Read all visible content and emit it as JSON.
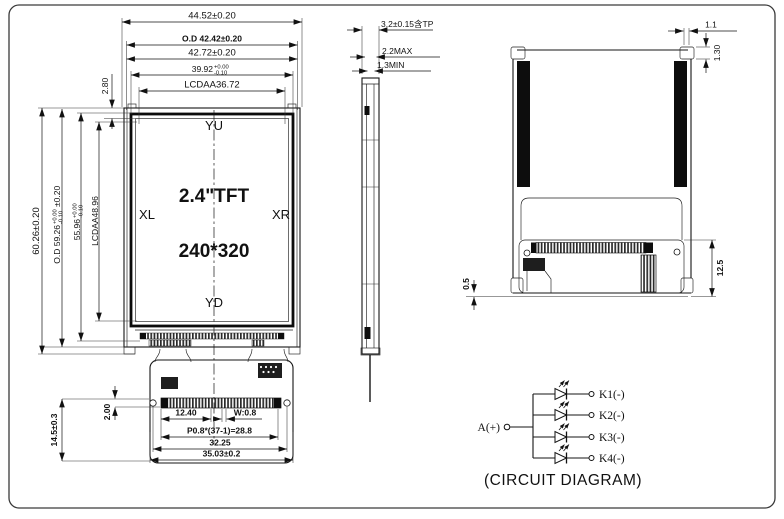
{
  "front": {
    "dims_top": {
      "total_width": "44.52±0.20",
      "od_width": "O.D 42.42±0.20",
      "frame_width": "42.72±0.20",
      "glass_width": "39.92",
      "glass_width_tol_up": "+0.00",
      "glass_width_tol_dn": "-0.10",
      "aa_width": "LCDAA36.72",
      "top_margin": "2.80"
    },
    "dims_left": {
      "total_height": "60.26±0.20",
      "od_height": "O.D 59.26",
      "od_height_tol_up": "+0.00",
      "od_height_tol_dn": "-0.10",
      "od_height_suffix": "±0.20",
      "pol_height": "55.96",
      "pol_height_tol_up": "+0.00",
      "pol_height_tol_dn": "-0.10",
      "aa_height": "LCDAA48.96"
    },
    "screen": {
      "marker_top": "YU",
      "marker_left": "XL",
      "marker_right": "XR",
      "marker_bottom": "YD",
      "type": "2.4\"TFT",
      "resolution": "240*320"
    },
    "dims_fpc": {
      "lead": "12.40",
      "pin_width": "W:0.8",
      "pitch": "P0.8*(37-1)=28.8",
      "hole_span": "32.25",
      "width": "35.03±0.2",
      "hole_offset": "2.00",
      "length": "14.5±0.3"
    }
  },
  "side": {
    "thickness": "3.2±0.15含TP",
    "max": "2.2MAX",
    "min": "1.3MIN"
  },
  "back": {
    "tab_width": "1.1",
    "tab_height": "1.30",
    "zone_height": "12.5",
    "protrusion": "0.5"
  },
  "circuit": {
    "anode": "A(+)",
    "cathodes": [
      "K1(-)",
      "K2(-)",
      "K3(-)",
      "K4(-)"
    ],
    "caption": "(CIRCUIT DIAGRAM)"
  },
  "colors": {
    "line": "#151515",
    "background": "#ffffff"
  }
}
